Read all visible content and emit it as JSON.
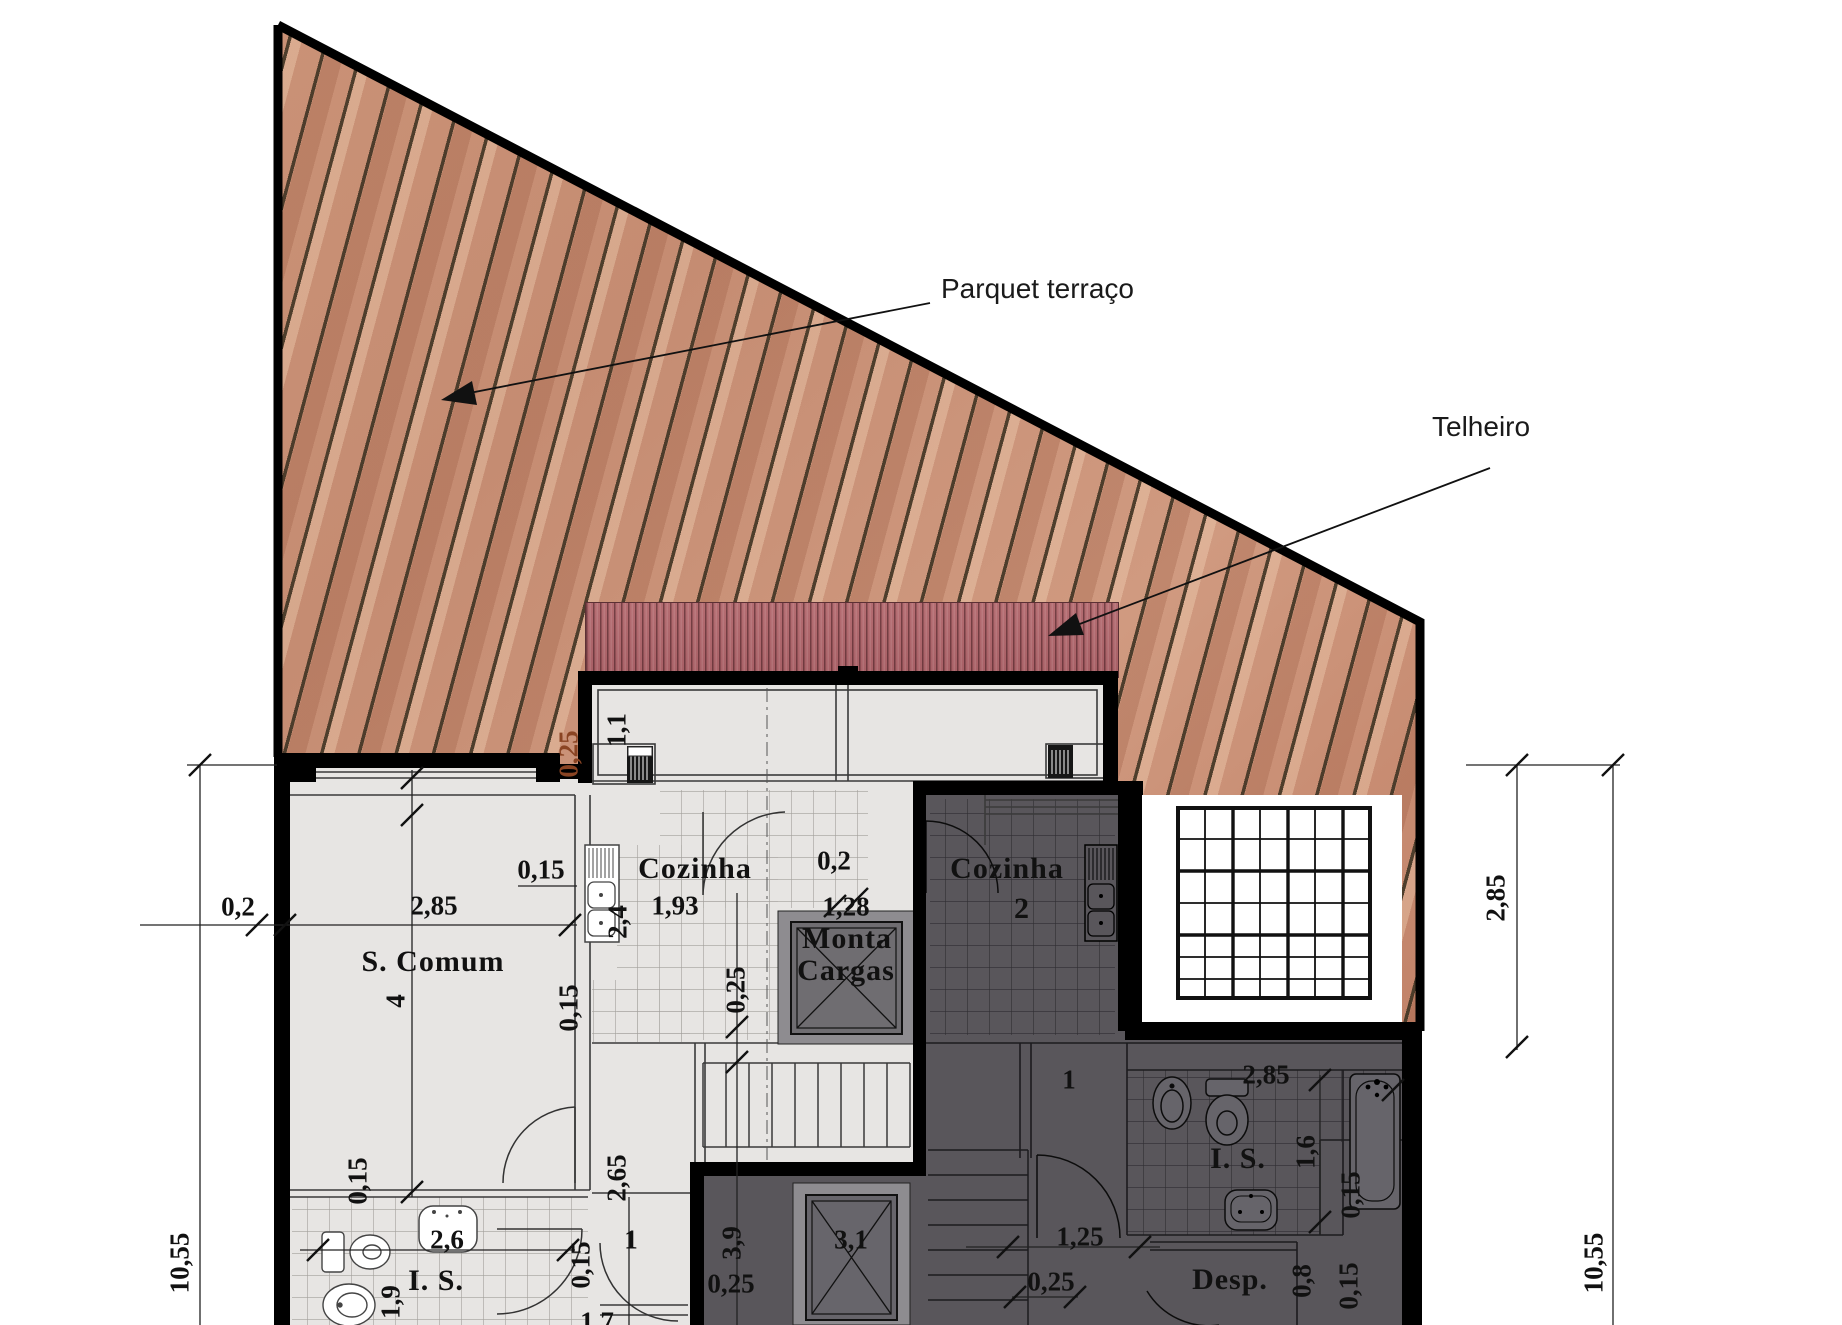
{
  "drawing": {
    "type": "architectural-floor-plan",
    "annotations": [
      {
        "name": "parquet-terrace-label",
        "text": "Parquet terraço",
        "x": 941,
        "y": 289,
        "rot": 0,
        "cls": "annot",
        "anchor": "left"
      },
      {
        "name": "telheiro-label",
        "text": "Telheiro",
        "x": 1432,
        "y": 427,
        "rot": 0,
        "cls": "annot",
        "anchor": "left"
      }
    ],
    "room_labels": [
      {
        "name": "room-label-cozinha-1",
        "text": "Cozinha",
        "x": 695,
        "y": 869,
        "rot": 0,
        "cls": "room"
      },
      {
        "name": "room-label-monta",
        "text": "Monta",
        "x": 847,
        "y": 939,
        "rot": 0,
        "cls": "room"
      },
      {
        "name": "room-label-cargas",
        "text": "Cargas",
        "x": 846,
        "y": 971,
        "rot": 0,
        "cls": "room"
      },
      {
        "name": "room-label-cozinha-2",
        "text": "Cozinha",
        "x": 1007,
        "y": 869,
        "rot": 0,
        "cls": "room"
      },
      {
        "name": "room-number-2",
        "text": "2",
        "x": 1022,
        "y": 909,
        "rot": 0,
        "cls": "room"
      },
      {
        "name": "room-label-s-comum",
        "text": "S. Comum",
        "x": 433,
        "y": 962,
        "rot": 0,
        "cls": "room"
      },
      {
        "name": "room-label-is-1",
        "text": "I. S.",
        "x": 436,
        "y": 1281,
        "rot": 0,
        "cls": "room"
      },
      {
        "name": "room-label-is-2",
        "text": "I. S.",
        "x": 1238,
        "y": 1159,
        "rot": 0,
        "cls": "room"
      },
      {
        "name": "room-label-desp",
        "text": "Desp.",
        "x": 1230,
        "y": 1280,
        "rot": 0,
        "cls": "room"
      }
    ],
    "dimensions": [
      {
        "text": "0,2",
        "x": 238,
        "y": 907,
        "rot": 0,
        "cls": "dim"
      },
      {
        "text": "2,85",
        "x": 434,
        "y": 906,
        "rot": 0,
        "cls": "dim"
      },
      {
        "text": "0,15",
        "x": 541,
        "y": 870,
        "rot": 0,
        "cls": "dim"
      },
      {
        "text": "10,55",
        "x": 180,
        "y": 1263,
        "rot": -90,
        "cls": "dim"
      },
      {
        "text": "10,55",
        "x": 1594,
        "y": 1263,
        "rot": -90,
        "cls": "dim"
      },
      {
        "text": "2,85",
        "x": 1496,
        "y": 898,
        "rot": -90,
        "cls": "dim"
      },
      {
        "text": "1,1",
        "x": 617,
        "y": 730,
        "rot": -90,
        "cls": "dim"
      },
      {
        "text": "0,25",
        "x": 569,
        "y": 754,
        "rot": -90,
        "cls": "dim brown"
      },
      {
        "text": "1,93",
        "x": 675,
        "y": 906,
        "rot": 0,
        "cls": "dim"
      },
      {
        "text": "2,4",
        "x": 618,
        "y": 922,
        "rot": -90,
        "cls": "dim"
      },
      {
        "text": "0,2",
        "x": 834,
        "y": 861,
        "rot": 0,
        "cls": "dim"
      },
      {
        "text": "1,28",
        "x": 846,
        "y": 907,
        "rot": 0,
        "cls": "dim"
      },
      {
        "text": "0,25",
        "x": 736,
        "y": 990,
        "rot": -90,
        "cls": "dim"
      },
      {
        "text": "4",
        "x": 396,
        "y": 1001,
        "rot": -90,
        "cls": "dim"
      },
      {
        "text": "0,15",
        "x": 358,
        "y": 1181,
        "rot": -90,
        "cls": "dim"
      },
      {
        "text": "2,6",
        "x": 447,
        "y": 1240,
        "rot": 0,
        "cls": "dim"
      },
      {
        "text": "1,9",
        "x": 391,
        "y": 1302,
        "rot": -90,
        "cls": "dim"
      },
      {
        "text": "2,65",
        "x": 617,
        "y": 1178,
        "rot": -90,
        "cls": "dim"
      },
      {
        "text": "0,15",
        "x": 569,
        "y": 1008,
        "rot": -90,
        "cls": "dim"
      },
      {
        "text": "1",
        "x": 631,
        "y": 1240,
        "rot": 0,
        "cls": "dim"
      },
      {
        "text": "0,15",
        "x": 581,
        "y": 1265,
        "rot": -90,
        "cls": "dim"
      },
      {
        "text": "3,9",
        "x": 732,
        "y": 1243,
        "rot": -90,
        "cls": "dim"
      },
      {
        "text": "0,25",
        "x": 731,
        "y": 1284,
        "rot": 0,
        "cls": "dim"
      },
      {
        "text": "3,1",
        "x": 851,
        "y": 1240,
        "rot": 0,
        "cls": "dim"
      },
      {
        "text": "1",
        "x": 1069,
        "y": 1080,
        "rot": 0,
        "cls": "dim"
      },
      {
        "text": "2,85",
        "x": 1266,
        "y": 1075,
        "rot": 0,
        "cls": "dim"
      },
      {
        "text": "1,6",
        "x": 1306,
        "y": 1152,
        "rot": -90,
        "cls": "dim"
      },
      {
        "text": "0,15",
        "x": 1351,
        "y": 1195,
        "rot": -90,
        "cls": "dim"
      },
      {
        "text": "1,25",
        "x": 1080,
        "y": 1237,
        "rot": 0,
        "cls": "dim"
      },
      {
        "text": "0,25",
        "x": 1051,
        "y": 1282,
        "rot": 0,
        "cls": "dim"
      },
      {
        "text": "0,8",
        "x": 1302,
        "y": 1281,
        "rot": -90,
        "cls": "dim"
      },
      {
        "text": "0,15",
        "x": 1349,
        "y": 1286,
        "rot": -90,
        "cls": "dim"
      },
      {
        "text": "1,7",
        "x": 597,
        "y": 1322,
        "rot": 0,
        "cls": "dim"
      }
    ],
    "colors": {
      "wood_base": "#c9917a",
      "wood_line": "#463827",
      "roof": "#b26a6f",
      "roof_line": "#6e3a3f",
      "floor_light": "#e7e5e3",
      "floor_dark": "#59565b",
      "wall": "#000000",
      "grid_white": "#ffffff",
      "text": "#111111",
      "brown_text": "#8a4423"
    }
  }
}
